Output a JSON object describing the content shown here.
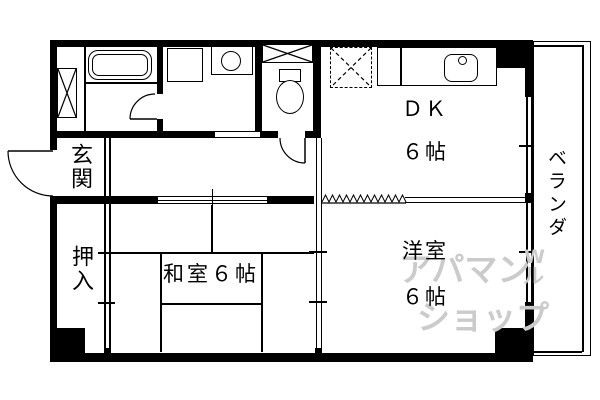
{
  "rooms": {
    "genkan": "玄関",
    "oshiire": "押入",
    "washitsu": "和室６帖",
    "dk_label": "ＤＫ",
    "dk_size": "６帖",
    "youshitsu_label": "洋室",
    "youshitsu_size": "６帖",
    "veranda": "ベランダ"
  },
  "watermark": {
    "line1": "アパマン",
    "line2": "ショップ",
    "mark_top": "W",
    "mark_bottom": "ル"
  },
  "fixtures": [
    "bathtub",
    "washing-machine",
    "washbasin",
    "toilet",
    "toilet-shelf",
    "pipe-space",
    "refrigerator-space",
    "kitchen-counter",
    "kitchen-sink"
  ],
  "colors": {
    "wall": "#000000",
    "background": "#ffffff",
    "watermark": "#cbcbcb"
  }
}
